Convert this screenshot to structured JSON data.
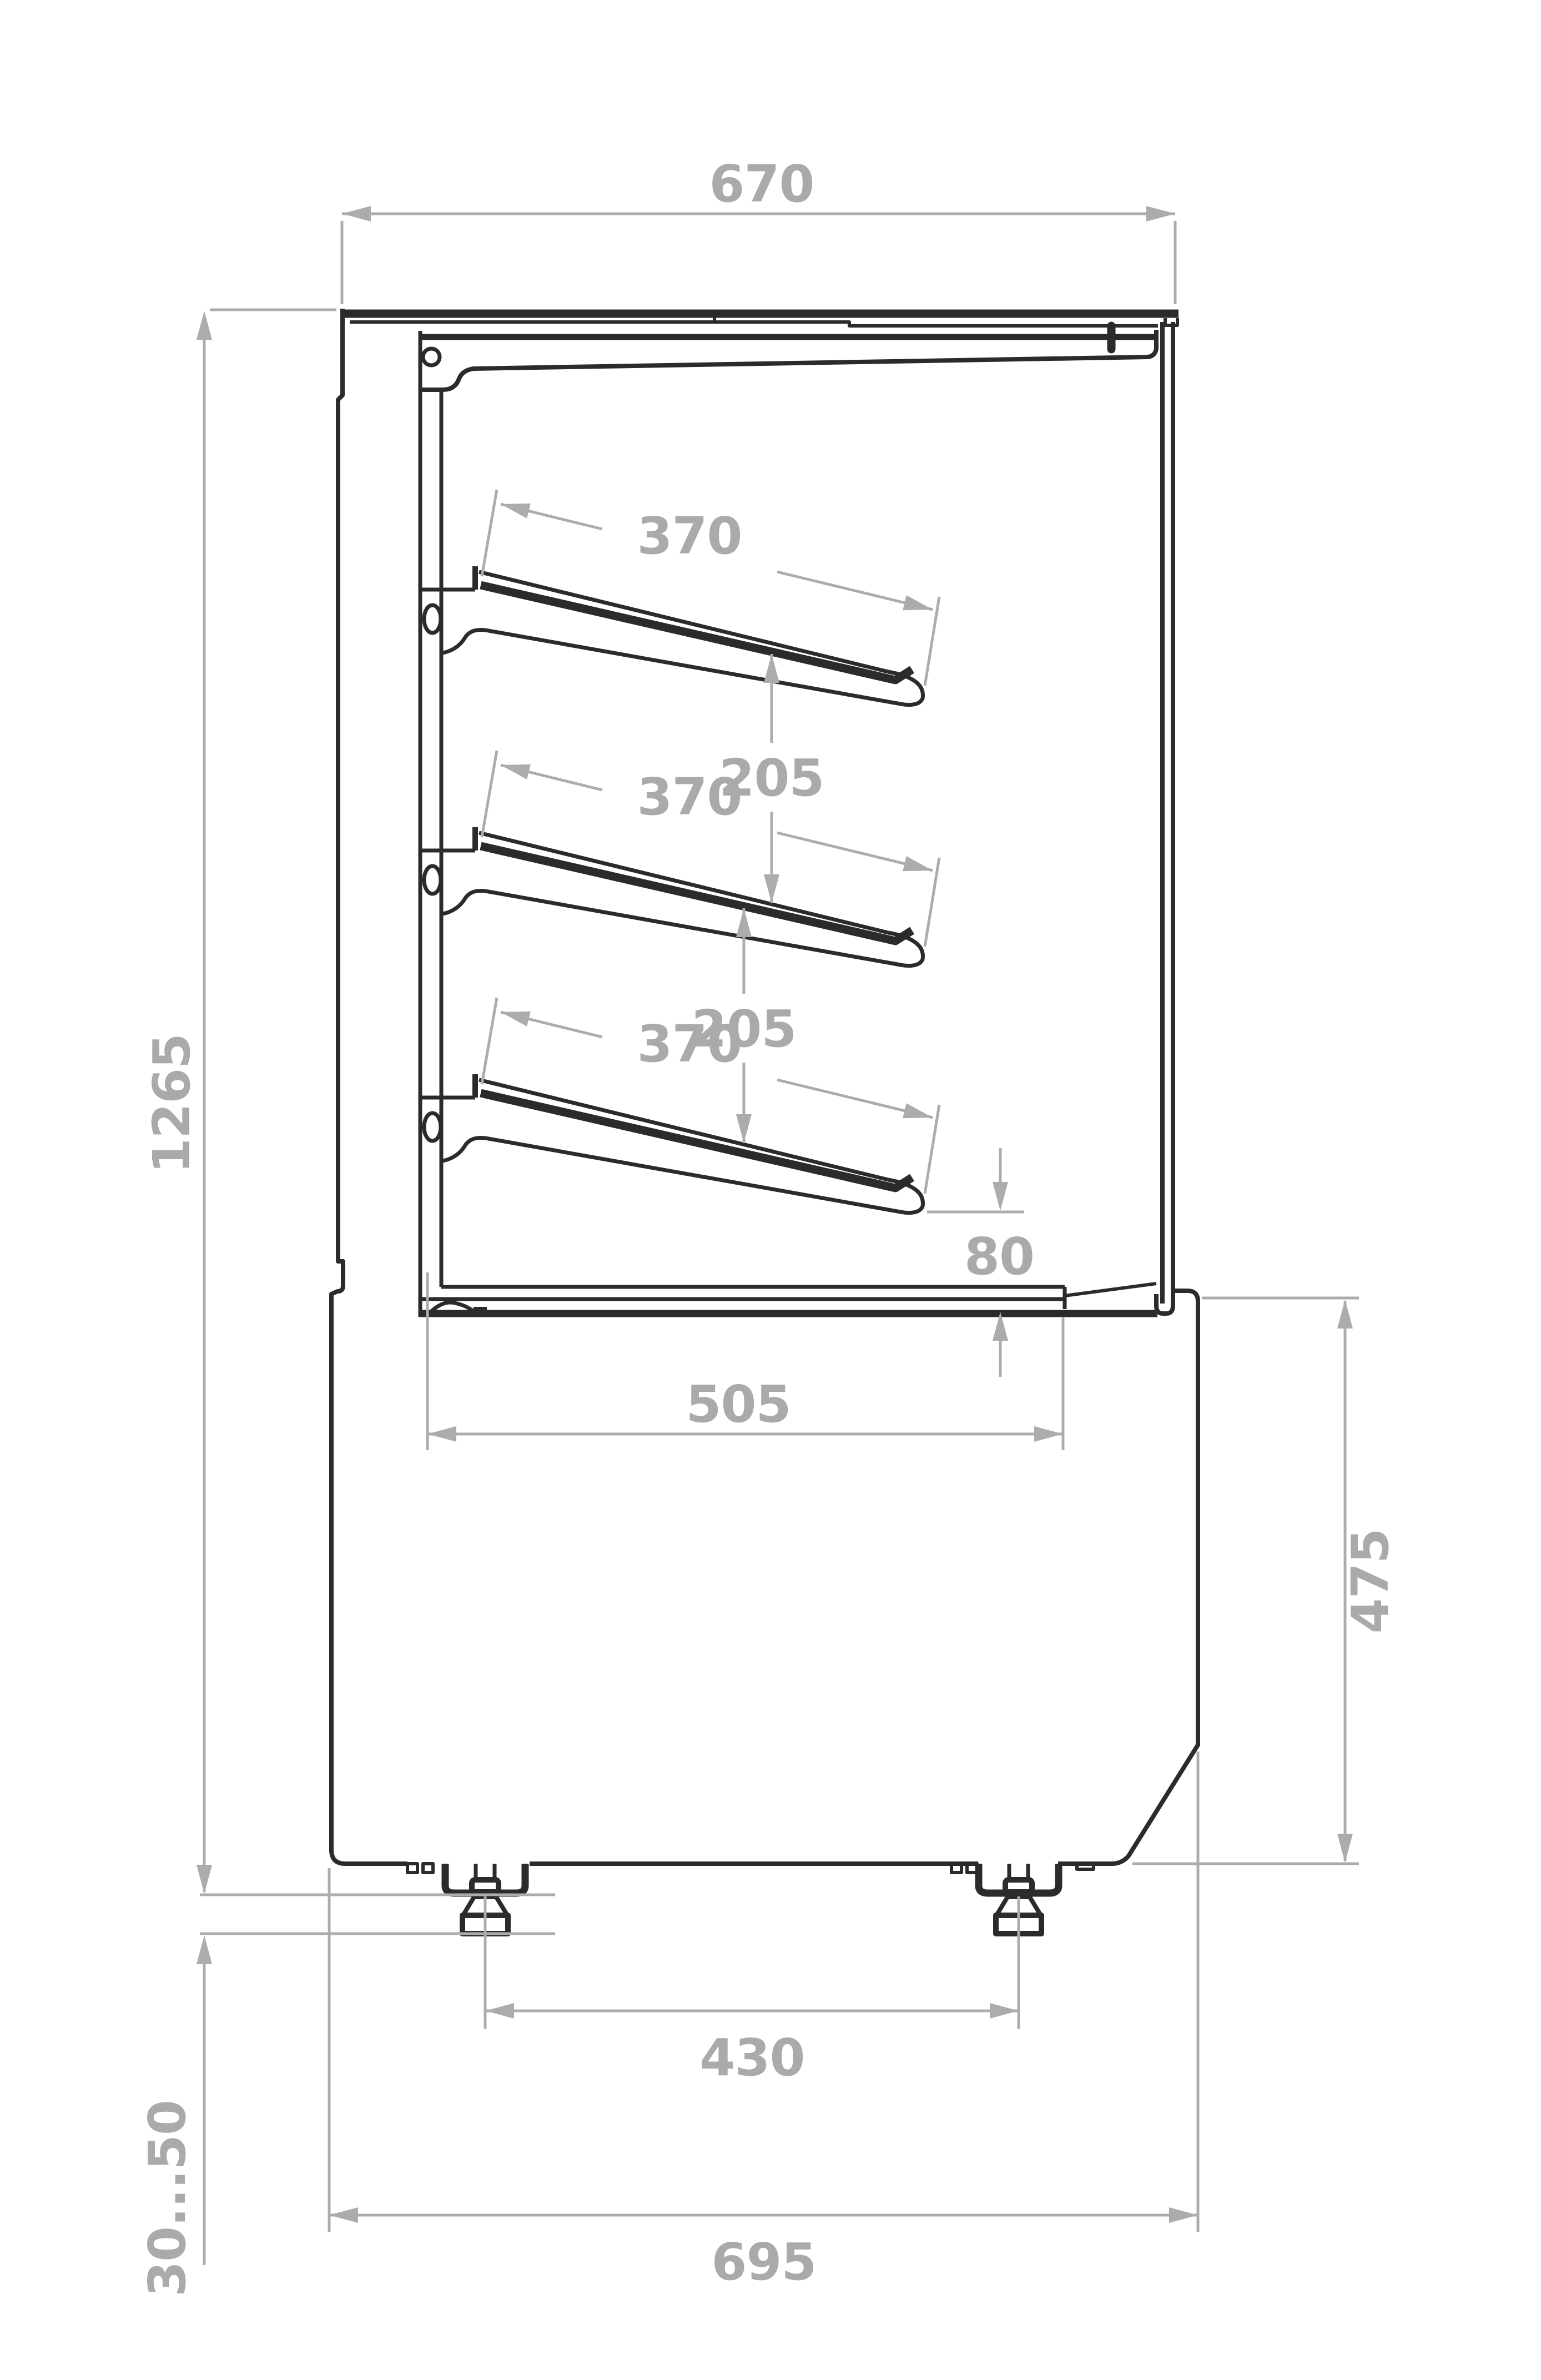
{
  "drawing": {
    "type": "technical-drawing-side-section",
    "subject": "refrigerated display case with three sloped shelves, glass front and adjustable feet",
    "labels": {
      "top_depth": "670",
      "overall_height": "1265",
      "shelf1_depth": "370",
      "shelf2_depth": "370",
      "shelf3_depth": "370",
      "shelf_gap1": "205",
      "shelf_gap2": "205",
      "deck_clearance": "80",
      "deck_depth": "505",
      "base_height": "475",
      "feet_spacing": "430",
      "base_depth": "695",
      "foot_adjust_range": "30...50"
    },
    "colors": {
      "background": "#ffffff",
      "outline": "#2d2b29",
      "dimension": "#abadad"
    }
  }
}
